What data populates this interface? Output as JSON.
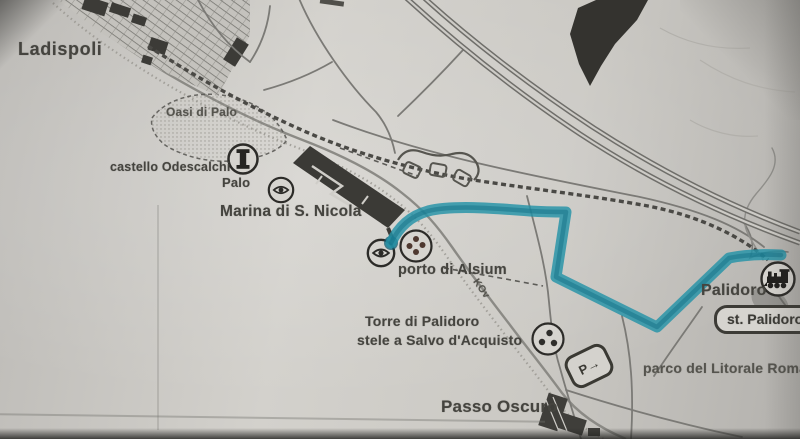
{
  "map": {
    "labels": {
      "ladispoli": "Ladispoli",
      "oasi_di_palo": "Oasi di Palo",
      "castello_odescalchi": "castello Odescalchi",
      "palo": "Palo",
      "marina_di_s_nicola": "Marina di S. Nicola",
      "porto_di_alsium": "porto di Alsium",
      "torre_di_palidoro": "Torre di Palidoro",
      "stele_salvo_acquisto": "stele a Salvo d'Acquisto",
      "km_marker": "KOv",
      "passo_oscuro": "Passo Oscuro",
      "palidoro": "Palidoro",
      "st_palidoro": "st. Palidoro",
      "parco_litorale": "parco del Litorale Roma"
    },
    "icons": {
      "castle_tower": "tower-icon",
      "viewpoint_palo": "eye-icon",
      "viewpoint_alsium": "eye-icon",
      "poi_dots_alsium": "dots-icon",
      "poi_dots_palidoro": "dots-icon",
      "railway_station": "locomotive-icon",
      "signpost_glyph": "P→"
    },
    "route": {
      "color": "#2392a7",
      "shade": "#136f86"
    }
  }
}
